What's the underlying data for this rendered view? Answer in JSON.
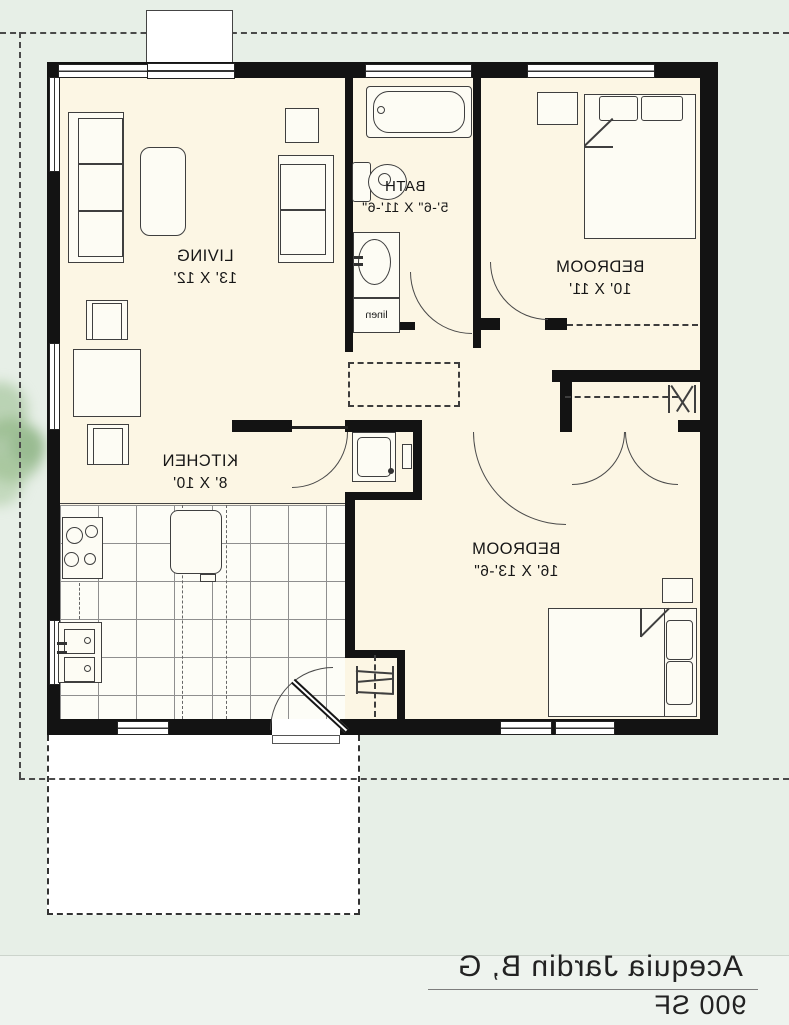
{
  "plan": {
    "rooms": [
      {
        "name": "LIVING",
        "dims": "13' X 12'"
      },
      {
        "name": "BATH",
        "dims": "5'-6\" X 11'-6\""
      },
      {
        "name": "BEDROOM",
        "dims": "10' X 11'"
      },
      {
        "name": "KITCHEN",
        "dims": "8' X 10'"
      },
      {
        "name": "BEDROOM",
        "dims": "16' X 13'-6\""
      }
    ],
    "closet_label": "linen",
    "footer": {
      "title": "Acequia Jardin B, G",
      "area": "900 SF"
    },
    "colors": {
      "background": "#e7efe7",
      "interior": "#fcf6e4",
      "wall": "#131313",
      "patio": "#ffffff",
      "tree": "#8fb684",
      "footer_bg": "#eef3ee"
    },
    "note_text_orientation": "mirrored"
  }
}
